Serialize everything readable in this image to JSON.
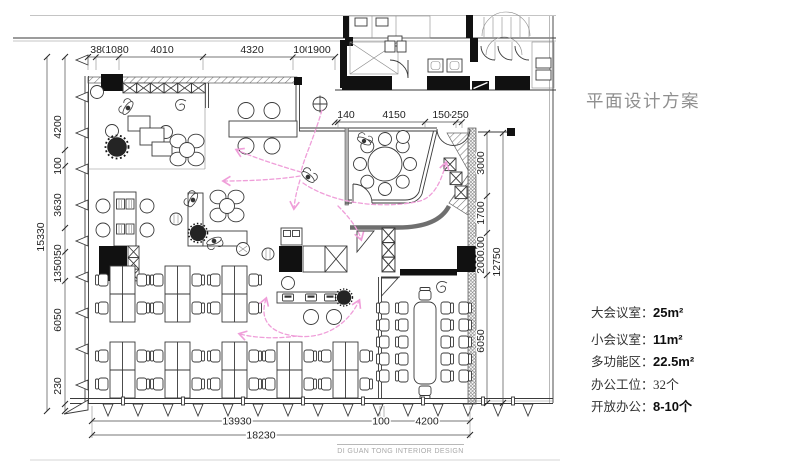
{
  "title": "平面设计方案",
  "watermark": "DI GUAN TONG INTERIOR DESIGN",
  "legend": [
    {
      "label": "大会议室：",
      "value": "25m²",
      "strong": true
    },
    {
      "label": "小会议室：",
      "value": "11m²",
      "strong": true
    },
    {
      "label": "多功能区：",
      "value": "22.5m²",
      "strong": true
    },
    {
      "label": "办公工位：",
      "value": "32个",
      "strong": false
    },
    {
      "label": "开放办公：",
      "value": "8-10个",
      "strong": true
    }
  ],
  "dims": {
    "top": [
      "380",
      "1080",
      "4010",
      "4320",
      "100",
      "1900"
    ],
    "mid": [
      "140",
      "4150",
      "1500",
      "250"
    ],
    "left": [
      "4200",
      "100",
      "3630",
      "1350",
      "1350",
      "6050",
      "230"
    ],
    "left_total": "15330",
    "right": [
      "3000",
      "1700",
      "100",
      "2000",
      "6050"
    ],
    "right_total": "12750",
    "bottom": [
      "13930",
      "100",
      "4200"
    ],
    "bottom_total": "18230"
  },
  "colors": {
    "arrow": "#ef9ed9",
    "line": "#3a3a3a",
    "wall": "#111111",
    "title": "#8f8f8f",
    "watermark": "#a8a8a8",
    "dim": "#1f1f1f"
  }
}
